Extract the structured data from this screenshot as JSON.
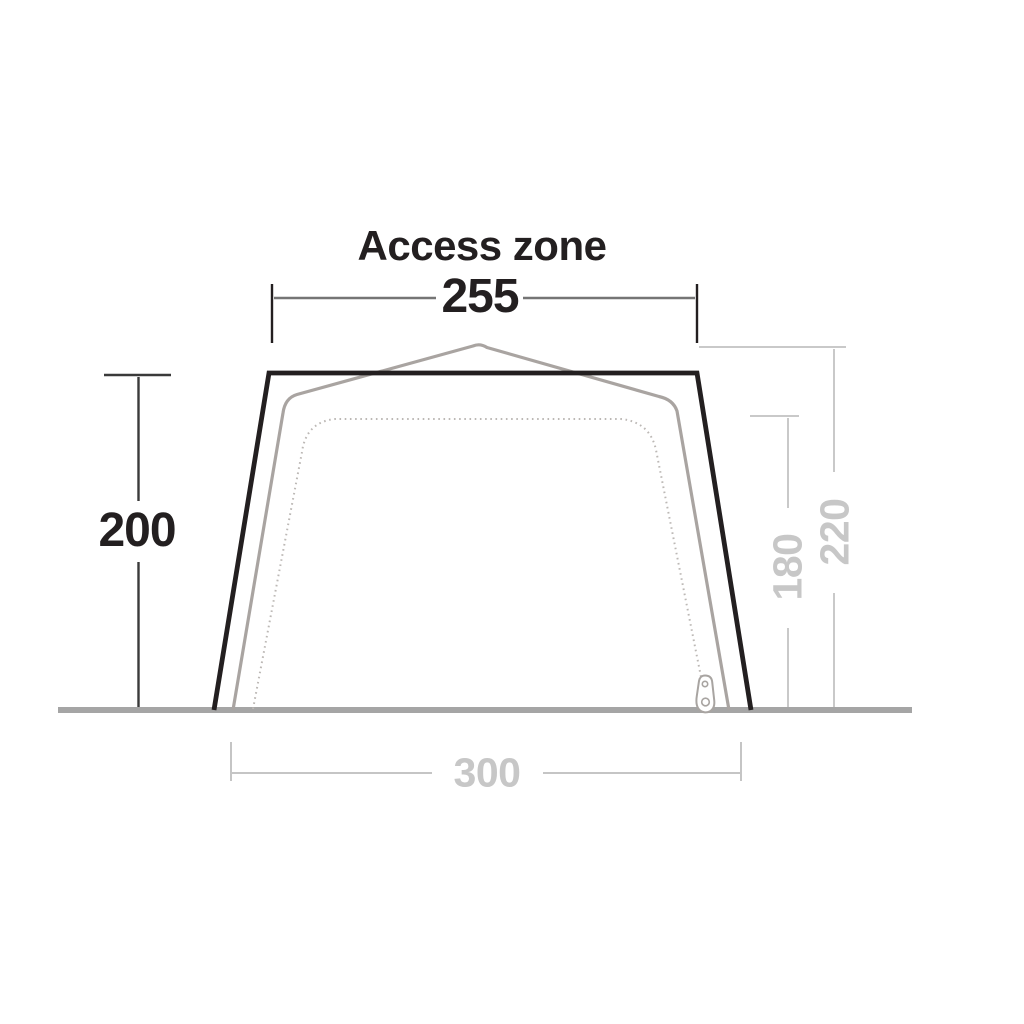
{
  "diagram": {
    "title": "Access zone",
    "dimensions": {
      "access_zone_width": "255",
      "frame_height": "200",
      "door_height": "180",
      "peak_height": "220",
      "base_width": "300"
    },
    "colors": {
      "outline_black": "#231f20",
      "fabric_gray": "#a9a4a1",
      "door_dotted_gray": "#bcb8b5",
      "dim_dark": "#3a3a3a",
      "dim_mid_gray": "#757575",
      "dim_light_gray": "#c7c7c7",
      "ground_gray": "#a5a5a5"
    }
  }
}
